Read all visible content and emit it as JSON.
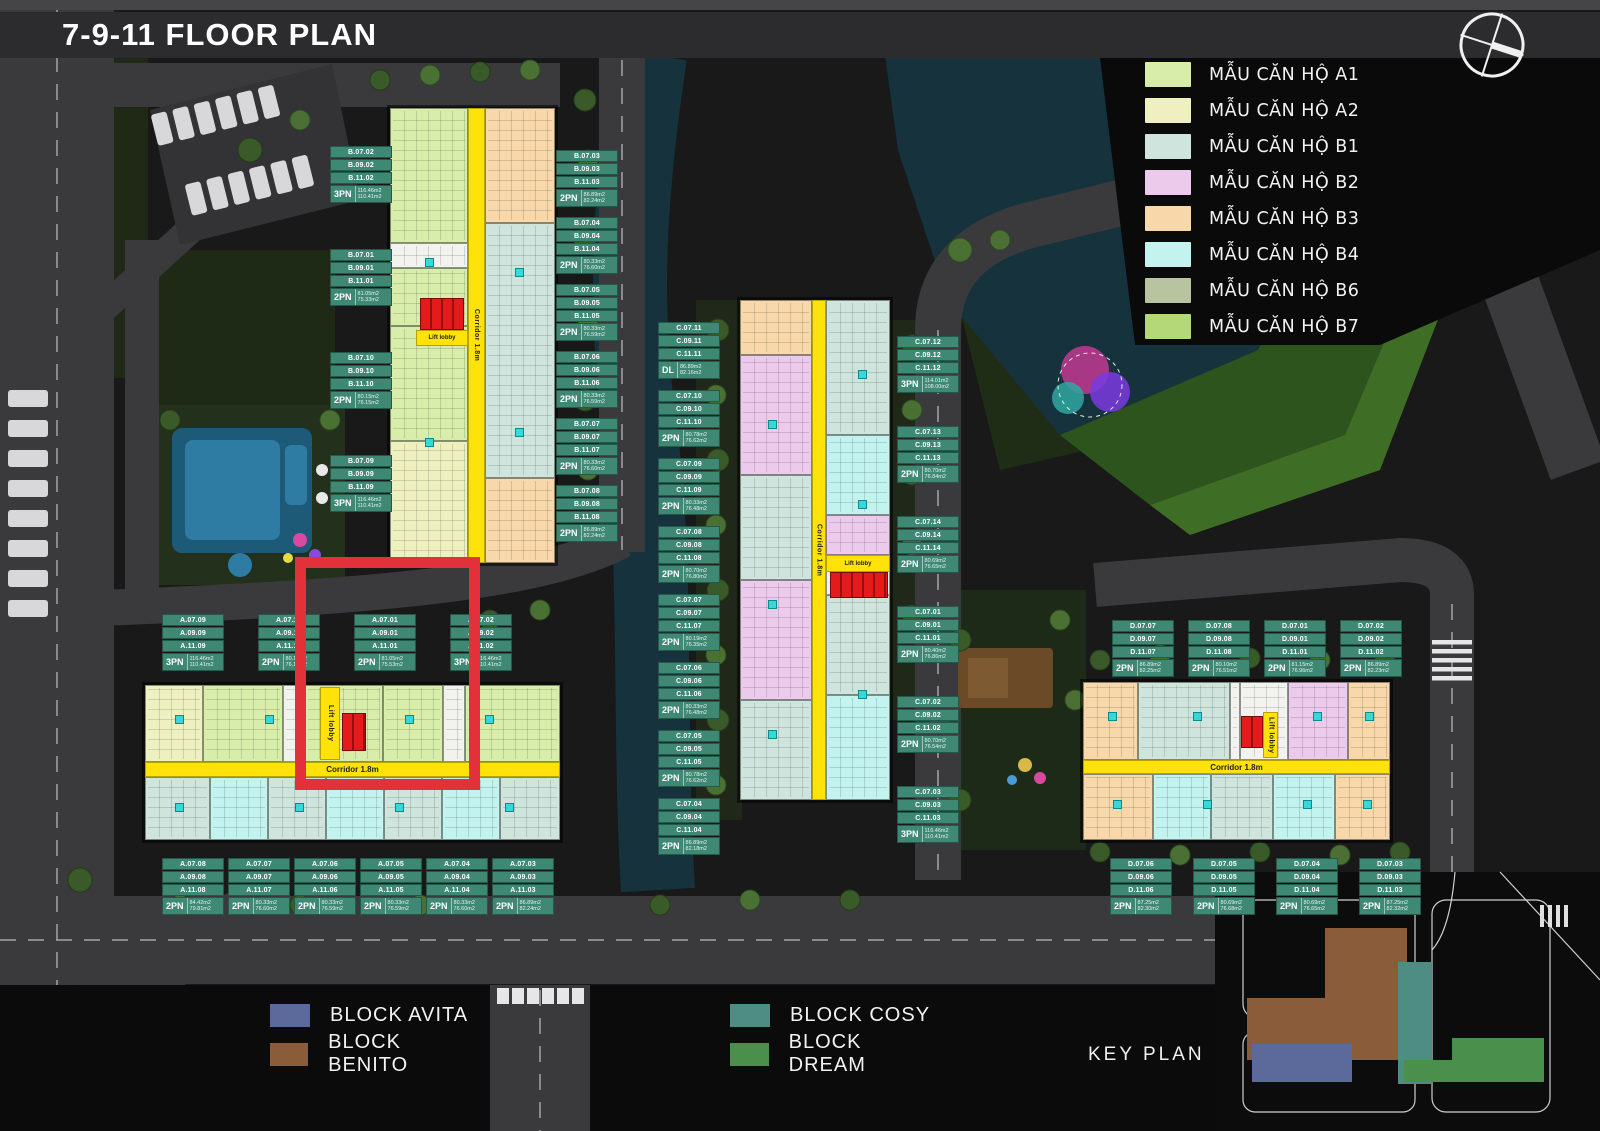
{
  "title": "7-9-11 FLOOR PLAN",
  "corridor_label": "Corridor 1.8m",
  "lift_lobby_label": "Lift lobby",
  "key_plan_label": "KEY PLAN",
  "unit_legend": [
    {
      "label": "MẪU CĂN HỘ A1",
      "color": "#d8edaa"
    },
    {
      "label": "MẪU CĂN HỘ A2",
      "color": "#eef0c0"
    },
    {
      "label": "MẪU CĂN HỘ B1",
      "color": "#cfe4dd"
    },
    {
      "label": "MẪU CĂN HỘ B2",
      "color": "#eccaec"
    },
    {
      "label": "MẪU CĂN HỘ B3",
      "color": "#f8d7ab"
    },
    {
      "label": "MẪU CĂN HỘ B4",
      "color": "#c2f3ef"
    },
    {
      "label": "MẪU CĂN HỘ B6",
      "color": "#b7c49f"
    },
    {
      "label": "MẪU CĂN HỘ B7",
      "color": "#b4d878"
    }
  ],
  "block_legend": [
    {
      "label": "BLOCK AVITA",
      "color": "#5b6a9a"
    },
    {
      "label": "BLOCK BENITO",
      "color": "#8a5c39"
    },
    {
      "label": "BLOCK COSY",
      "color": "#4e8d83"
    },
    {
      "label": "BLOCK DREAM",
      "color": "#4a8f4c"
    }
  ],
  "labels": {
    "benito_left": [
      {
        "units": [
          "B.07.02",
          "B.09.02",
          "B.11.02"
        ],
        "type": "3PN",
        "areas": [
          "116.46m2",
          "110.41m2"
        ]
      },
      {
        "units": [
          "B.07.01",
          "B.09.01",
          "B.11.01"
        ],
        "type": "2PN",
        "areas": [
          "81.05m2",
          "75.33m2"
        ]
      },
      {
        "units": [
          "B.07.10",
          "B.09.10",
          "B.11.10"
        ],
        "type": "2PN",
        "areas": [
          "80.15m2",
          "76.15m2"
        ]
      },
      {
        "units": [
          "B.07.09",
          "B.09.09",
          "B.11.09"
        ],
        "type": "3PN",
        "areas": [
          "116.46m2",
          "110.41m2"
        ]
      }
    ],
    "benito_right": [
      {
        "units": [
          "B.07.03",
          "B.09.03",
          "B.11.03"
        ],
        "type": "2PN",
        "areas": [
          "86.89m2",
          "82.24m2"
        ]
      },
      {
        "units": [
          "B.07.04",
          "B.09.04",
          "B.11.04"
        ],
        "type": "2PN",
        "areas": [
          "80.33m2",
          "76.60m2"
        ]
      },
      {
        "units": [
          "B.07.05",
          "B.09.05",
          "B.11.05"
        ],
        "type": "2PN",
        "areas": [
          "80.33m2",
          "76.59m2"
        ]
      },
      {
        "units": [
          "B.07.06",
          "B.09.06",
          "B.11.06"
        ],
        "type": "2PN",
        "areas": [
          "80.33m2",
          "76.59m2"
        ]
      },
      {
        "units": [
          "B.07.07",
          "B.09.07",
          "B.11.07"
        ],
        "type": "2PN",
        "areas": [
          "80.33m2",
          "76.60m2"
        ]
      },
      {
        "units": [
          "B.07.08",
          "B.09.08",
          "B.11.08"
        ],
        "type": "2PN",
        "areas": [
          "86.89m2",
          "82.24m2"
        ]
      }
    ],
    "cosy_left": [
      {
        "units": [
          "C.07.11",
          "C.09.11",
          "C.11.11"
        ],
        "type": "DL",
        "areas": [
          "86.89m2",
          "82.16m2"
        ]
      },
      {
        "units": [
          "C.07.10",
          "C.09.10",
          "C.11.10"
        ],
        "type": "2PN",
        "areas": [
          "80.78m2",
          "76.62m2"
        ]
      },
      {
        "units": [
          "C.07.09",
          "C.09.09",
          "C.11.09"
        ],
        "type": "2PN",
        "areas": [
          "80.33m2",
          "76.48m2"
        ]
      },
      {
        "units": [
          "C.07.08",
          "C.09.08",
          "C.11.08"
        ],
        "type": "2PN",
        "areas": [
          "80.70m2",
          "76.80m2"
        ]
      },
      {
        "units": [
          "C.07.07",
          "C.09.07",
          "C.11.07"
        ],
        "type": "2PN",
        "areas": [
          "80.19m2",
          "76.35m2"
        ]
      },
      {
        "units": [
          "C.07.06",
          "C.09.06",
          "C.11.06"
        ],
        "type": "2PN",
        "areas": [
          "80.33m2",
          "76.48m2"
        ]
      },
      {
        "units": [
          "C.07.05",
          "C.09.05",
          "C.11.05"
        ],
        "type": "2PN",
        "areas": [
          "80.78m2",
          "76.62m2"
        ]
      },
      {
        "units": [
          "C.07.04",
          "C.09.04",
          "C.11.04"
        ],
        "type": "2PN",
        "areas": [
          "86.89m2",
          "82.18m2"
        ]
      }
    ],
    "cosy_right": [
      {
        "units": [
          "C.07.12",
          "C.09.12",
          "C.11.12"
        ],
        "type": "3PN",
        "areas": [
          "114.01m2",
          "108.00m2"
        ]
      },
      {
        "units": [
          "C.07.13",
          "C.09.13",
          "C.11.13"
        ],
        "type": "2PN",
        "areas": [
          "80.70m2",
          "76.84m2"
        ]
      },
      {
        "units": [
          "C.07.14",
          "C.09.14",
          "C.11.14"
        ],
        "type": "2PN",
        "areas": [
          "80.69m2",
          "76.65m2"
        ]
      },
      {
        "units": [
          "C.07.01",
          "C.09.01",
          "C.11.01"
        ],
        "type": "2PN",
        "areas": [
          "80.40m2",
          "76.86m2"
        ]
      },
      {
        "units": [
          "C.07.02",
          "C.09.02",
          "C.11.02"
        ],
        "type": "2PN",
        "areas": [
          "80.70m2",
          "76.54m2"
        ]
      },
      {
        "units": [
          "C.07.03",
          "C.09.03",
          "C.11.03"
        ],
        "type": "3PN",
        "areas": [
          "116.46m2",
          "110.41m2"
        ]
      }
    ],
    "avita_top": [
      {
        "units": [
          "A.07.09",
          "A.09.09",
          "A.11.09"
        ],
        "type": "3PN",
        "areas": [
          "116.46m2",
          "110.41m2"
        ]
      },
      {
        "units": [
          "A.07.10",
          "A.09.10",
          "A.11.10"
        ],
        "type": "2PN",
        "areas": [
          "80.15m2",
          "76.15m2"
        ]
      },
      {
        "units": [
          "A.07.01",
          "A.09.01",
          "A.11.01"
        ],
        "type": "2PN",
        "areas": [
          "81.05m2",
          "75.53m2"
        ]
      },
      {
        "units": [
          "A.07.02",
          "A.09.02",
          "A.11.02"
        ],
        "type": "3PN",
        "areas": [
          "116.46m2",
          "110.41m2"
        ]
      }
    ],
    "avita_bottom": [
      {
        "units": [
          "A.07.08",
          "A.09.08",
          "A.11.08"
        ],
        "type": "2PN",
        "areas": [
          "84.42m2",
          "79.81m2"
        ]
      },
      {
        "units": [
          "A.07.07",
          "A.09.07",
          "A.11.07"
        ],
        "type": "2PN",
        "areas": [
          "80.33m2",
          "76.60m2"
        ]
      },
      {
        "units": [
          "A.07.06",
          "A.09.06",
          "A.11.06"
        ],
        "type": "2PN",
        "areas": [
          "80.33m2",
          "76.59m2"
        ]
      },
      {
        "units": [
          "A.07.05",
          "A.09.05",
          "A.11.05"
        ],
        "type": "2PN",
        "areas": [
          "80.33m2",
          "76.59m2"
        ]
      },
      {
        "units": [
          "A.07.04",
          "A.09.04",
          "A.11.04"
        ],
        "type": "2PN",
        "areas": [
          "80.33m2",
          "76.60m2"
        ]
      },
      {
        "units": [
          "A.07.03",
          "A.09.03",
          "A.11.03"
        ],
        "type": "2PN",
        "areas": [
          "86.89m2",
          "82.24m2"
        ]
      }
    ],
    "dream_top": [
      {
        "units": [
          "D.07.07",
          "D.09.07",
          "D.11.07"
        ],
        "type": "2PN",
        "areas": [
          "86.89m2",
          "82.25m2"
        ]
      },
      {
        "units": [
          "D.07.08",
          "D.09.08",
          "D.11.08"
        ],
        "type": "2PN",
        "areas": [
          "80.10m2",
          "76.51m2"
        ]
      },
      {
        "units": [
          "D.07.01",
          "D.09.01",
          "D.11.01"
        ],
        "type": "2PN",
        "areas": [
          "81.15m2",
          "76.96m2"
        ]
      },
      {
        "units": [
          "D.07.02",
          "D.09.02",
          "D.11.02"
        ],
        "type": "2PN",
        "areas": [
          "86.89m2",
          "82.23m2"
        ]
      }
    ],
    "dream_bottom": [
      {
        "units": [
          "D.07.06",
          "D.09.06",
          "D.11.06"
        ],
        "type": "2PN",
        "areas": [
          "87.25m2",
          "82.30m2"
        ]
      },
      {
        "units": [
          "D.07.05",
          "D.09.05",
          "D.11.05"
        ],
        "type": "2PN",
        "areas": [
          "80.69m2",
          "76.68m2"
        ]
      },
      {
        "units": [
          "D.07.04",
          "D.09.04",
          "D.11.04"
        ],
        "type": "2PN",
        "areas": [
          "80.69m2",
          "76.65m2"
        ]
      },
      {
        "units": [
          "D.07.03",
          "D.09.03",
          "D.11.03"
        ],
        "type": "2PN",
        "areas": [
          "87.25m2",
          "82.32m2"
        ]
      }
    ]
  }
}
